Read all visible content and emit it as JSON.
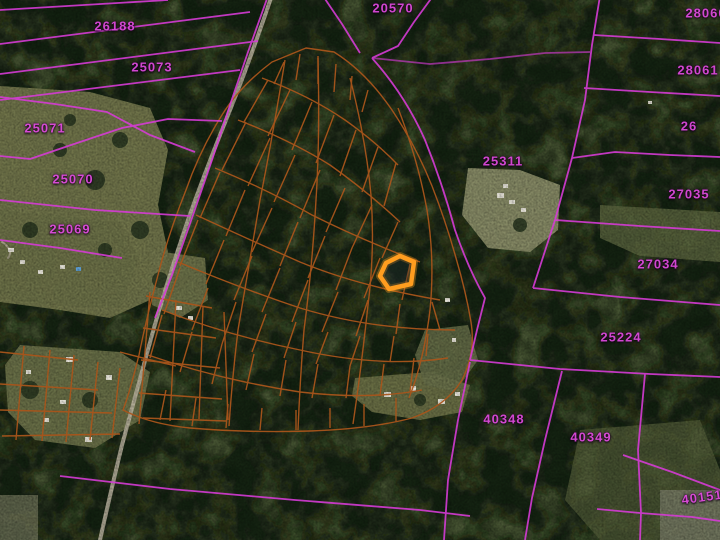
{
  "map": {
    "kind": "aerial-cadastral-parcel-map",
    "colors": {
      "parcel_boundary": "#d63bd6",
      "parcel_label": "#e04ae0",
      "lot_boundary": "#a9551b",
      "selected_lot_outline": "#ff9d1f",
      "road": "#bdb5a2",
      "forest": "#2e3a21"
    },
    "selected_lot": {
      "highlighted": true,
      "x": 397,
      "y": 272
    },
    "parcel_labels": [
      {
        "text": "20570",
        "x": 393,
        "y": 8
      },
      {
        "text": "26188",
        "x": 115,
        "y": 26
      },
      {
        "text": "28060",
        "x": 706,
        "y": 13
      },
      {
        "text": "25073",
        "x": 152,
        "y": 67
      },
      {
        "text": "28061",
        "x": 698,
        "y": 70
      },
      {
        "text": "25071",
        "x": 45,
        "y": 128
      },
      {
        "text": "26",
        "x": 689,
        "y": 126
      },
      {
        "text": "25311",
        "x": 503,
        "y": 161
      },
      {
        "text": "25070",
        "x": 73,
        "y": 179
      },
      {
        "text": "27035",
        "x": 689,
        "y": 194
      },
      {
        "text": "25069",
        "x": 70,
        "y": 229
      },
      {
        "text": "27034",
        "x": 658,
        "y": 264
      },
      {
        "text": "25224",
        "x": 621,
        "y": 337
      },
      {
        "text": "40348",
        "x": 504,
        "y": 419
      },
      {
        "text": "40349",
        "x": 591,
        "y": 437
      },
      {
        "text": "40151",
        "x": 702,
        "y": 497
      }
    ]
  }
}
